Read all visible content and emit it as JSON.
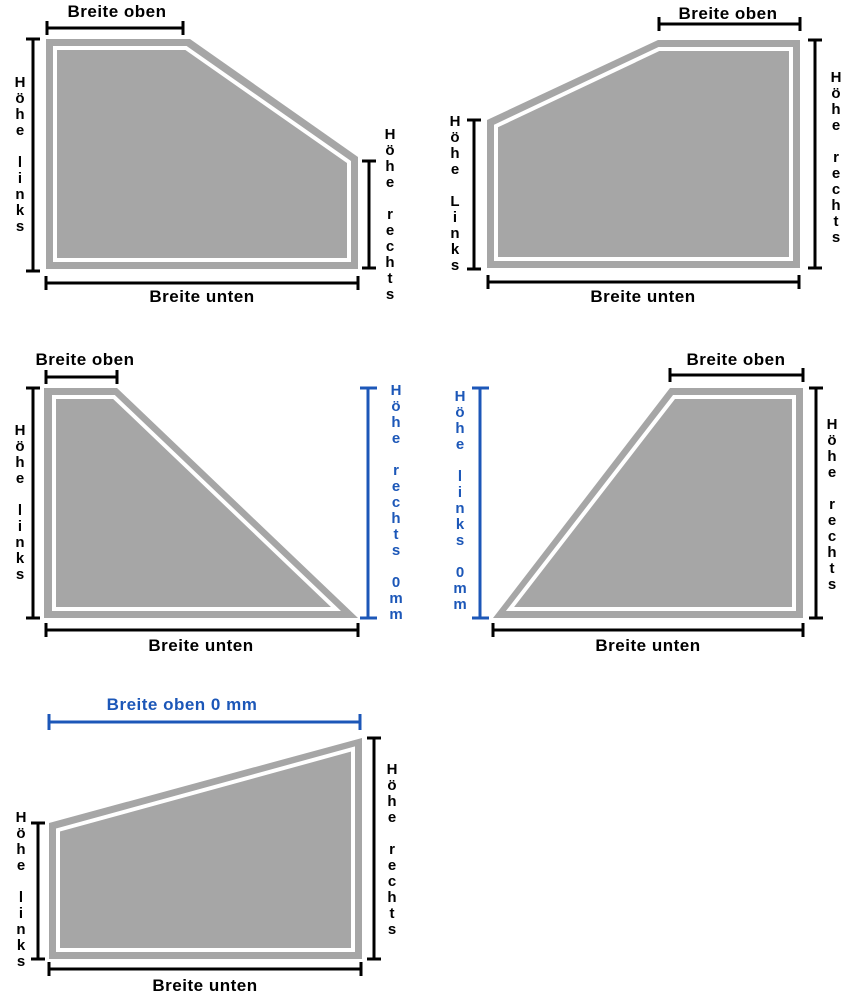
{
  "colors": {
    "shape_gray": "#a6a6a6",
    "inner_line_white": "#ffffff",
    "dimension_black": "#000000",
    "accent_blue": "#1c57b8",
    "background": "#ffffff"
  },
  "panels": [
    {
      "shape": "trapezoid-sloped-top-right",
      "breite_oben": "Breite oben",
      "hoehe_links": "Höhe links",
      "hoehe_rechts": "Höhe rechts",
      "breite_unten": "Breite unten"
    },
    {
      "shape": "trapezoid-sloped-top-left",
      "breite_oben": "Breite oben",
      "hoehe_links": "Höhe Links",
      "hoehe_rechts": "Höhe rechts",
      "breite_unten": "Breite unten"
    },
    {
      "shape": "triangle-slope-down-to-right",
      "breite_oben": "Breite oben",
      "hoehe_links": "Höhe links",
      "hoehe_rechts": "Höhe rechts 0mm",
      "breite_unten": "Breite unten"
    },
    {
      "shape": "triangle-slope-up-to-right",
      "breite_oben": "Breite oben",
      "hoehe_links": "Höhe links 0mm",
      "hoehe_rechts": "Höhe rechts",
      "breite_unten": "Breite unten"
    },
    {
      "shape": "quad-rising-top-edge",
      "breite_oben": "Breite oben 0 mm",
      "hoehe_links": "Höhe links",
      "hoehe_rechts": "Höhe rechts",
      "breite_unten": "Breite unten"
    }
  ]
}
